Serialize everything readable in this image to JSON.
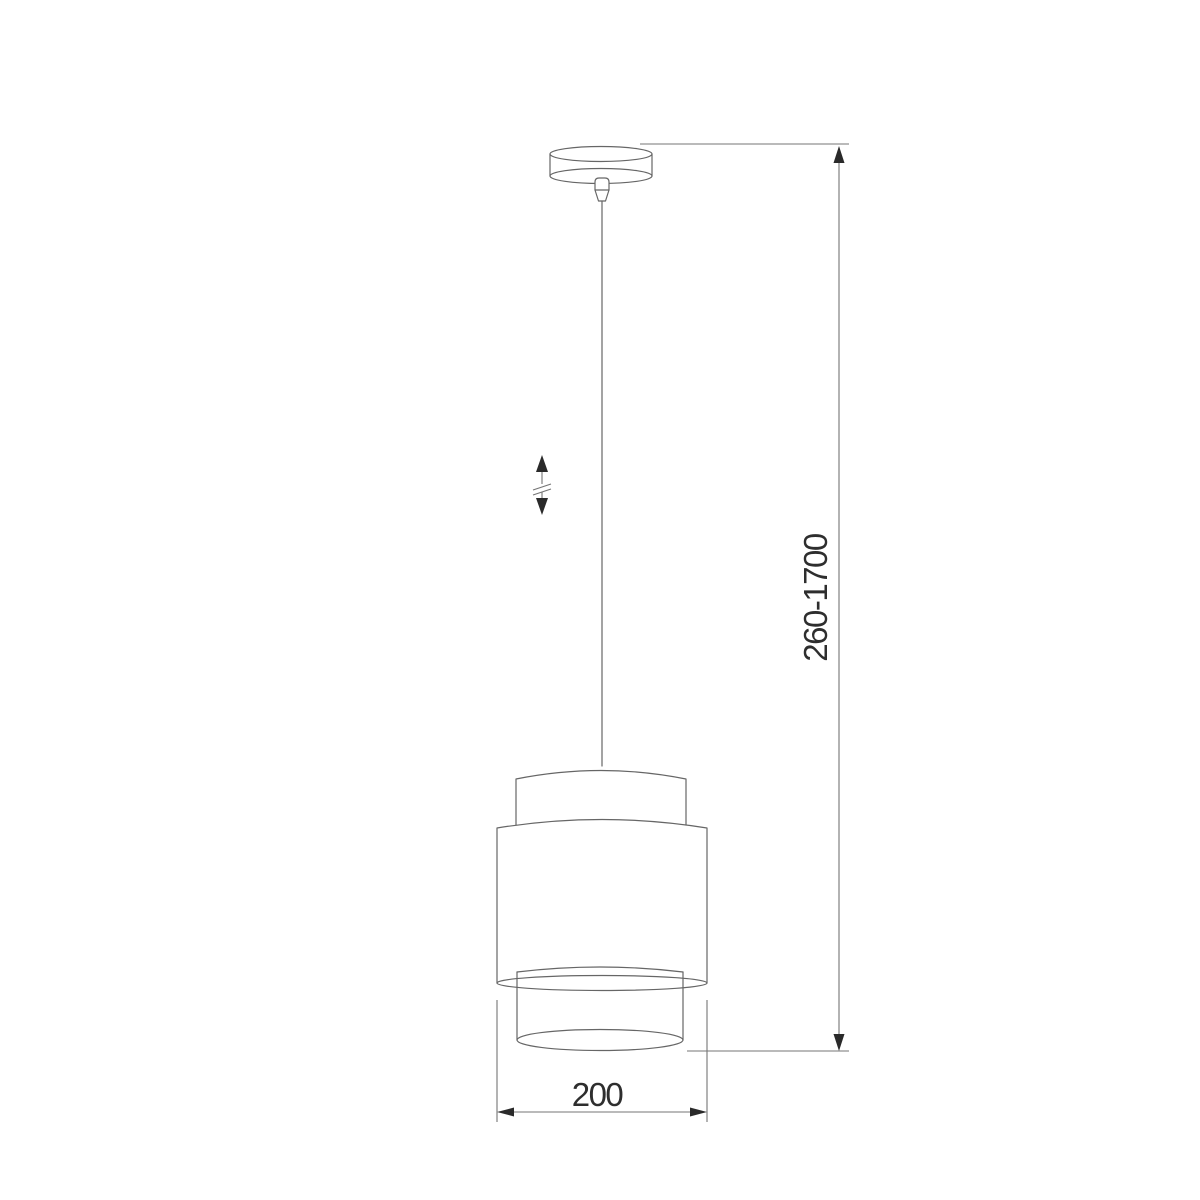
{
  "drawing": {
    "type": "technical-dimension-drawing",
    "subject": "pendant-lamp",
    "background_color": "#ffffff",
    "line_color": "#666666",
    "text_color": "#2e2e2e",
    "dimensions": {
      "suspension_height": {
        "label": "260-1700",
        "orientation": "vertical",
        "unit": "mm"
      },
      "shade_diameter": {
        "label": "200",
        "orientation": "horizontal",
        "unit": "mm"
      }
    },
    "symbols": {
      "height_adjustment": "double-headed-arrow-with-break"
    },
    "parts": [
      "ceiling-canopy",
      "cord-grip",
      "suspension-cord",
      "lampshade-upper-drum",
      "lampshade-outer-drum",
      "lampshade-inner-diffuser"
    ]
  }
}
